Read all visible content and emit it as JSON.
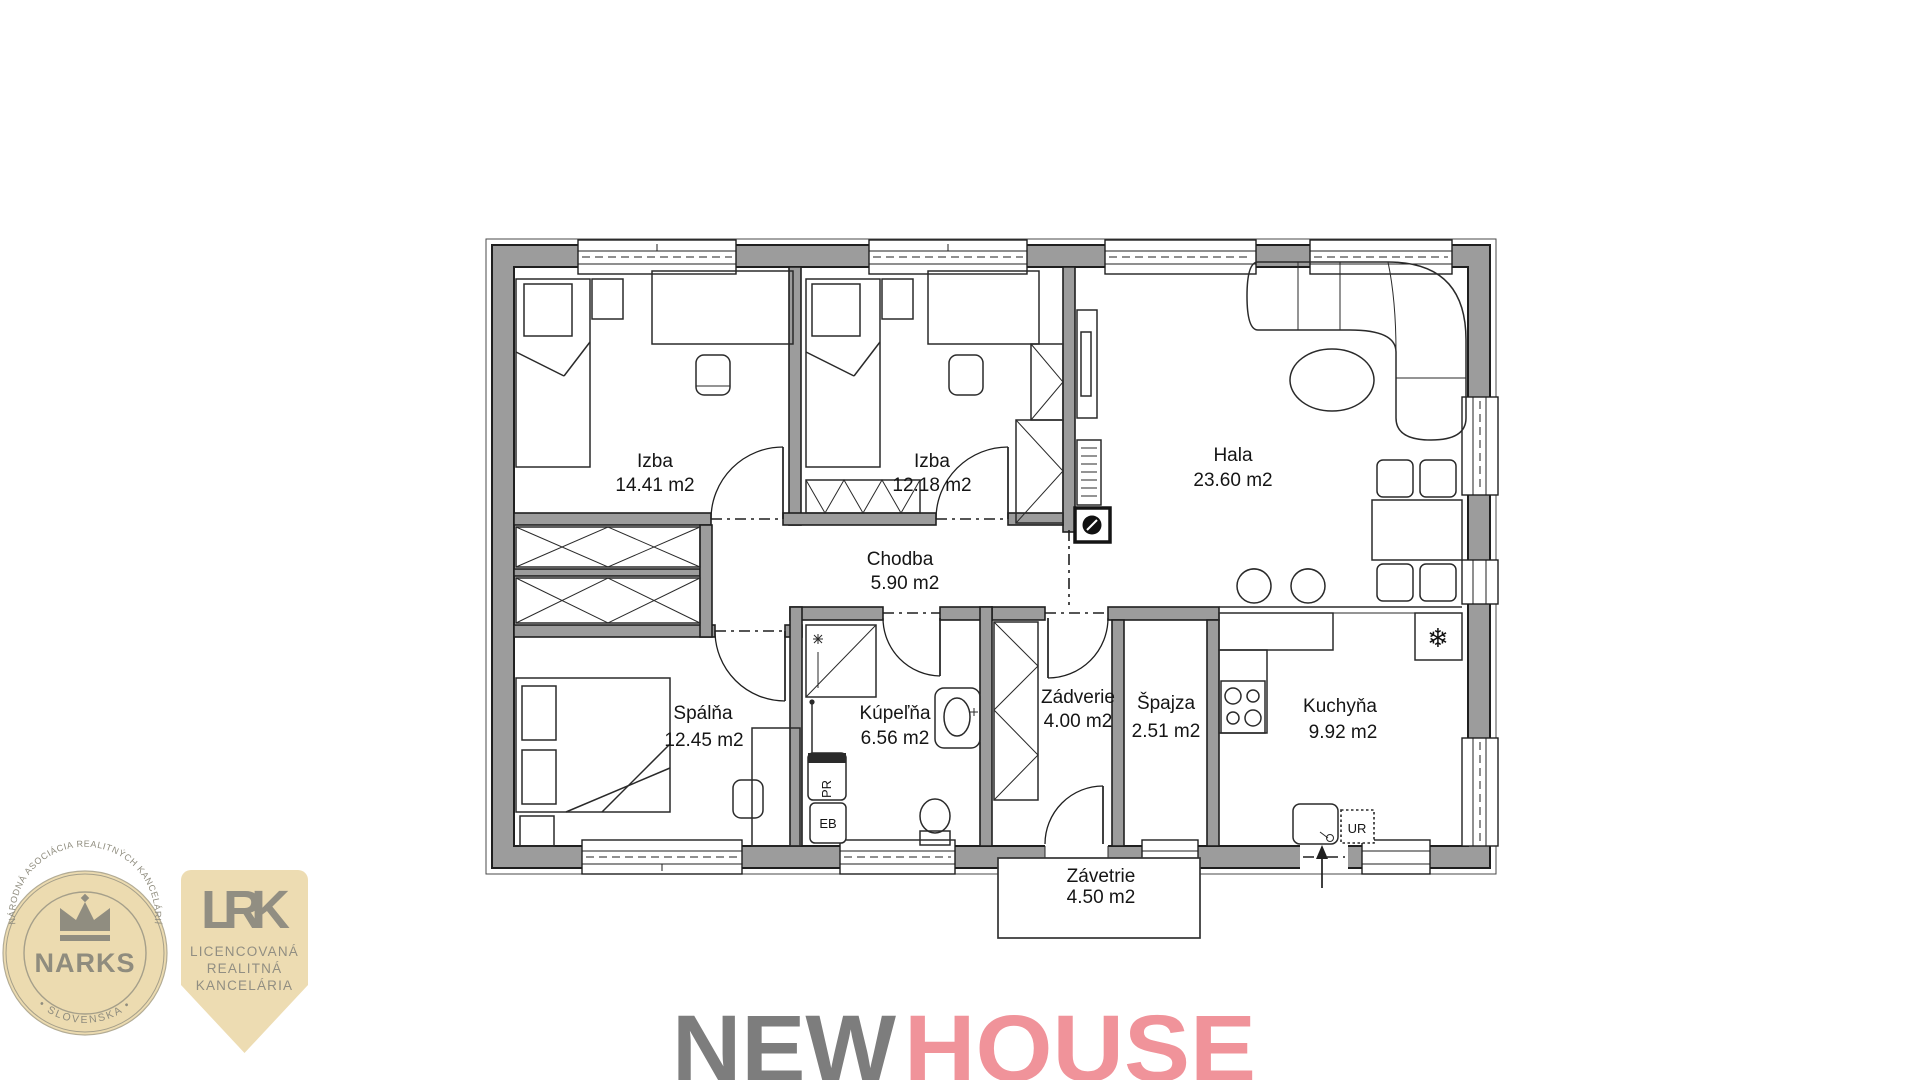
{
  "floor_plan": {
    "rooms": [
      {
        "id": "izba1",
        "name": "Izba",
        "area": "14.41 m2"
      },
      {
        "id": "izba2",
        "name": "Izba",
        "area": "12.18 m2"
      },
      {
        "id": "hala",
        "name": "Hala",
        "area": "23.60 m2"
      },
      {
        "id": "chodba",
        "name": "Chodba",
        "area": "5.90 m2"
      },
      {
        "id": "spalna",
        "name": "Spálňa",
        "area": "12.45 m2"
      },
      {
        "id": "kupelna",
        "name": "Kúpeľňa",
        "area": "6.56 m2"
      },
      {
        "id": "zadverie",
        "name": "Zádverie",
        "area": "4.00 m2"
      },
      {
        "id": "spajza",
        "name": "Špajza",
        "area": "2.51 m2"
      },
      {
        "id": "kuchyna",
        "name": "Kuchyňa",
        "area": "9.92 m2"
      },
      {
        "id": "zavetrie",
        "name": "Závetrie",
        "area": "4.50 m2"
      }
    ],
    "labels": {
      "washing_machine": "PR",
      "boiler": "EB",
      "dishwasher": "UR",
      "fridge_symbol": "❄"
    }
  },
  "logos": {
    "narks": {
      "title": "NARKS",
      "arc_top": "NÁRODNÁ ASOCIÁCIA REALITNÝCH KANCELÁRIÍ",
      "arc_bottom": "• SLOVENSKA •",
      "bg_color": "#ECDBB0",
      "text_color": "#8F8C7E"
    },
    "lrk": {
      "abbr": "LRK",
      "line1": "LICENCOVANÁ",
      "line2": "REALITNÁ",
      "line3": "KANCELÁRIA",
      "bg_color": "#EDDCB2",
      "text_color": "#918E82"
    },
    "newhouse": {
      "word1": "NEW",
      "word2": "HOUSE",
      "color1": "#7D7D7D",
      "color2": "#F0939A"
    }
  }
}
